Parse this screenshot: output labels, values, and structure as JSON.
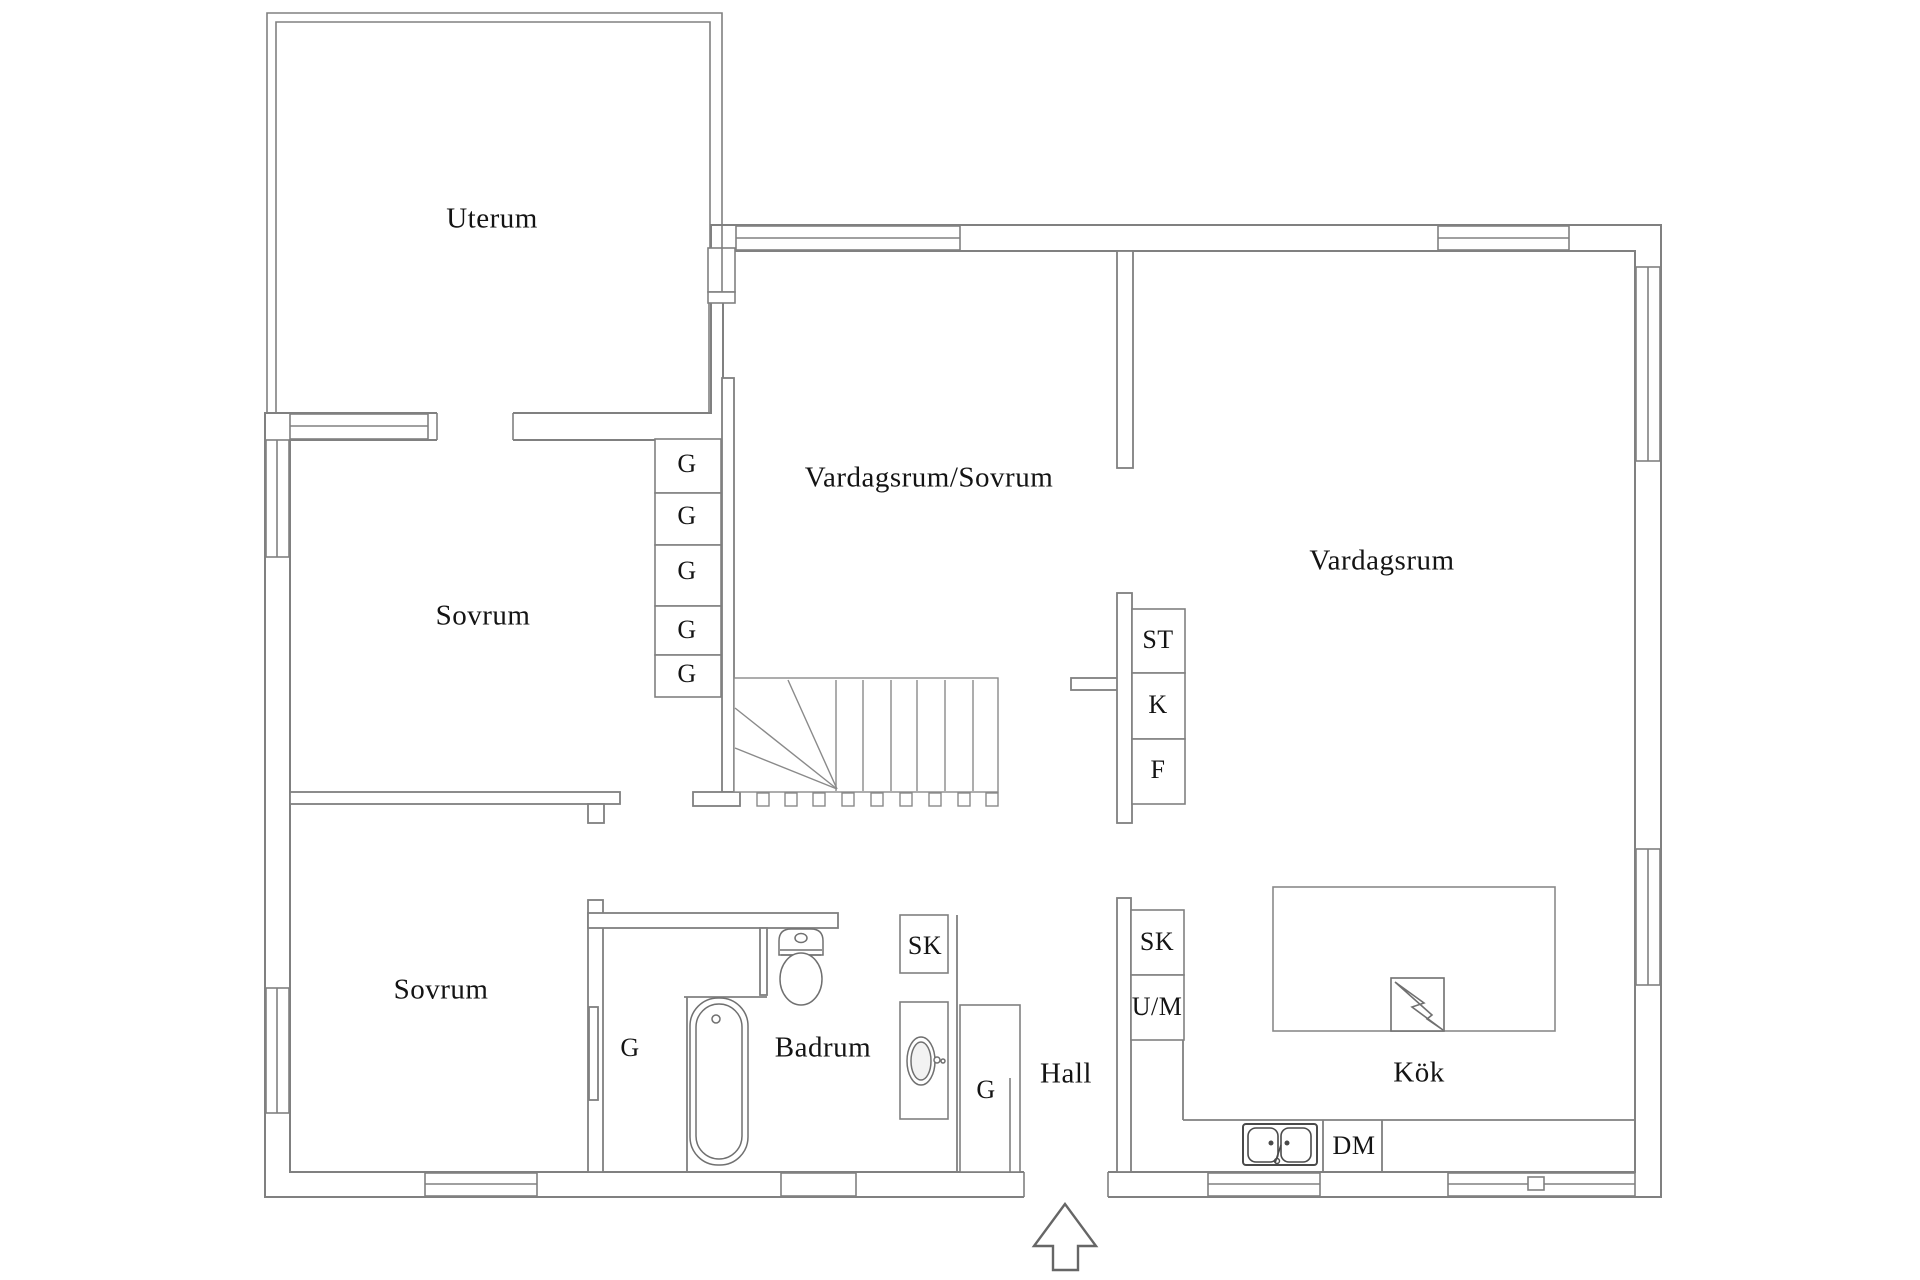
{
  "floorplan": {
    "rooms": {
      "uterum": "Uterum",
      "sovrum_upper": "Sovrum",
      "vardagsrum_sovrum": "Vardagsrum/Sovrum",
      "vardagsrum": "Vardagsrum",
      "sovrum_lower": "Sovrum",
      "badrum": "Badrum",
      "hall": "Hall",
      "kok": "Kök"
    },
    "closets": {
      "g1": "G",
      "g2": "G",
      "g3": "G",
      "g4": "G",
      "g5": "G",
      "st": "ST",
      "k": "K",
      "f": "F",
      "sk_badrum": "SK",
      "g_badrum": "G",
      "g_hall": "G",
      "sk_kok": "SK",
      "um": "U/M",
      "dm": "DM"
    },
    "fixtures": {
      "toilet": "toilet",
      "bathtub": "bathtub",
      "washbasin": "washbasin",
      "kitchen_sink": "double-sink",
      "stove": "stove",
      "staircase": "staircase",
      "entrance_arrow": "entrance-arrow"
    },
    "colors": {
      "wall_line": "#808080",
      "fixture_line": "#6e6e6e",
      "sink_line": "#4a4a4a",
      "text": "#141414",
      "background": "#ffffff"
    }
  }
}
